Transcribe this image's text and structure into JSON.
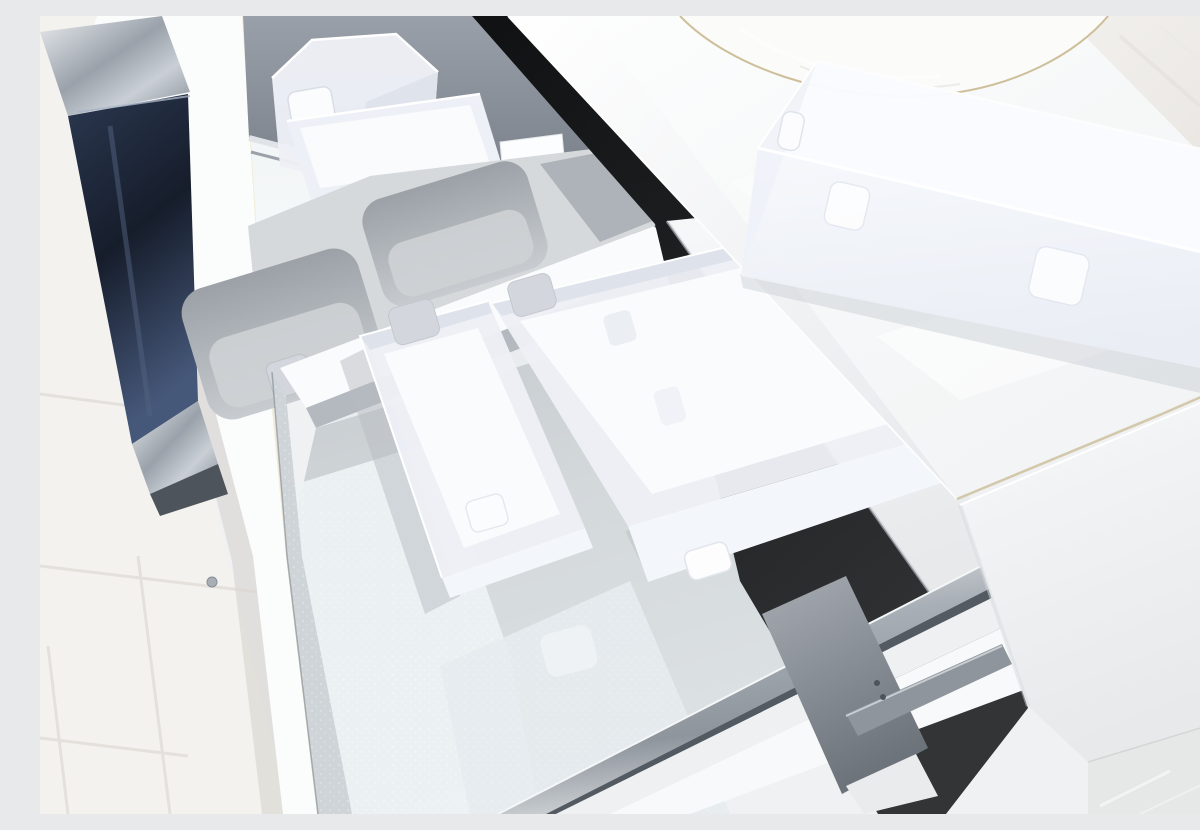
{
  "scene": {
    "type": "photograph",
    "description": "Close-up of an open white bathroom vanity with two pull-out drawers containing frosted translucent plastic organizer bins and a grey moulded divider tray; a white countertop with a round white vessel sink sits above, a large frosted storage bin rests on the counter, glossy black drawer fronts and chrome gallery rails are visible, and a white tiled floor shows at lower left.",
    "objects": [
      {
        "name": "upper-drawer",
        "description": "shallow pull-out drawer with silver base, metallic grey back panel and chrome gallery rails"
      },
      {
        "name": "square-frosted-cup",
        "description": "tall square translucent organizer cup with dimple"
      },
      {
        "name": "wide-frosted-box",
        "description": "low wide translucent organizer box"
      },
      {
        "name": "divider-tray",
        "description": "grey moulded organizer tray with rounded-square compartments"
      },
      {
        "name": "lower-drawer",
        "description": "deep pull-out drawer with textured silver base and white walls"
      },
      {
        "name": "frosted-bin-small",
        "description": "rectangular translucent bin with clip tabs"
      },
      {
        "name": "frosted-bin-large",
        "description": "long rectangular translucent bin with clip tabs and handle cutout"
      },
      {
        "name": "counter-bin",
        "description": "large frosted storage bin resting on the countertop"
      },
      {
        "name": "vessel-sink",
        "description": "round white ceramic vessel sink, base edge visible"
      },
      {
        "name": "countertop",
        "description": "glossy white counter slab with end fascia"
      },
      {
        "name": "black-drawer-front",
        "description": "glossy black cabinet front in shadow gap"
      },
      {
        "name": "navy-drawer-edge",
        "description": "dark glossy drawer front seen edge-on with chrome trim"
      },
      {
        "name": "drawer-slide-hardware",
        "description": "grey metal drawer runner and bracket"
      },
      {
        "name": "tile-floor",
        "description": "large white floor tiles with grout lines"
      },
      {
        "name": "stone-floor-corner",
        "description": "grey stone floor visible at bottom right"
      }
    ]
  },
  "palette": {
    "background": "#f0f1f2",
    "tile": "#f4f2ee",
    "grout": "#e2ded8",
    "tile_shadow": "#d9d6d1",
    "white_panel": "#fbfcfc",
    "warm_glint": "#ece4c4",
    "frosted": "#edf0f6",
    "frosted_interior": "#f9fbfd",
    "frosted_wall_shade": "#dee3eb",
    "frosted_front": "#f3f6fa",
    "tray_surface": "#d6d9dc",
    "tray_wall": "#adb3b8",
    "band_white": "#fafbfc",
    "band_shadow": "#b3b9bf",
    "band_lower": "#e9ecef",
    "clip_tab": "#d3d7dd",
    "white_tab": "#fbfcfd",
    "bright_patch": "#ecf1f3",
    "counter_shadow": "#c7cbd2",
    "sink_white": "#fbfbfa",
    "sink_ring": "#c6b488",
    "edge_tan": "#cfc3a3",
    "marble_floor": "#e6e7e7",
    "hardware_grey": "#8e959c",
    "screw_grey": "#a8aeb5",
    "shadow_soft": "#b7bcc2"
  }
}
